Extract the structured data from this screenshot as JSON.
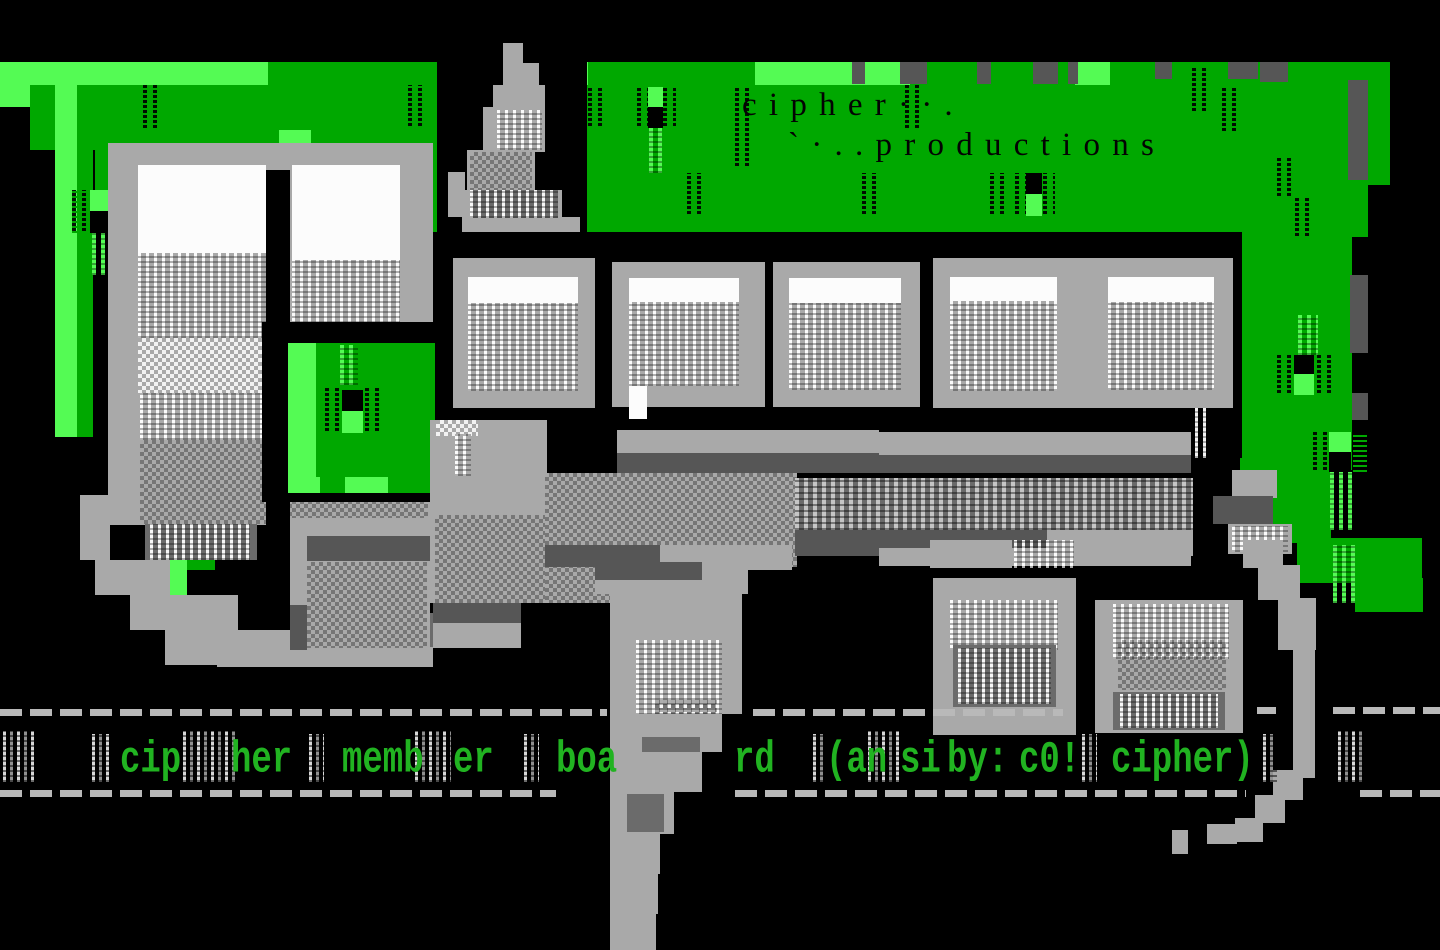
{
  "palette": {
    "green": "#00a800",
    "bright": "#54fb54",
    "gray": "#a9a9a9",
    "dgray": "#565656",
    "mgray": "#6b6b6b",
    "white": "#fcfcfc",
    "capgreen": "#21b321",
    "dash": "#b9b9b9"
  },
  "title": {
    "line1": "c i p h e r · · .",
    "line2": "` · . . p r o d u c t i o n s"
  },
  "caption": {
    "words": [
      "cip",
      "her",
      "memb",
      "er",
      "boa",
      "rd",
      "(an",
      "si",
      "by:",
      "c0!",
      "cipher)"
    ]
  }
}
